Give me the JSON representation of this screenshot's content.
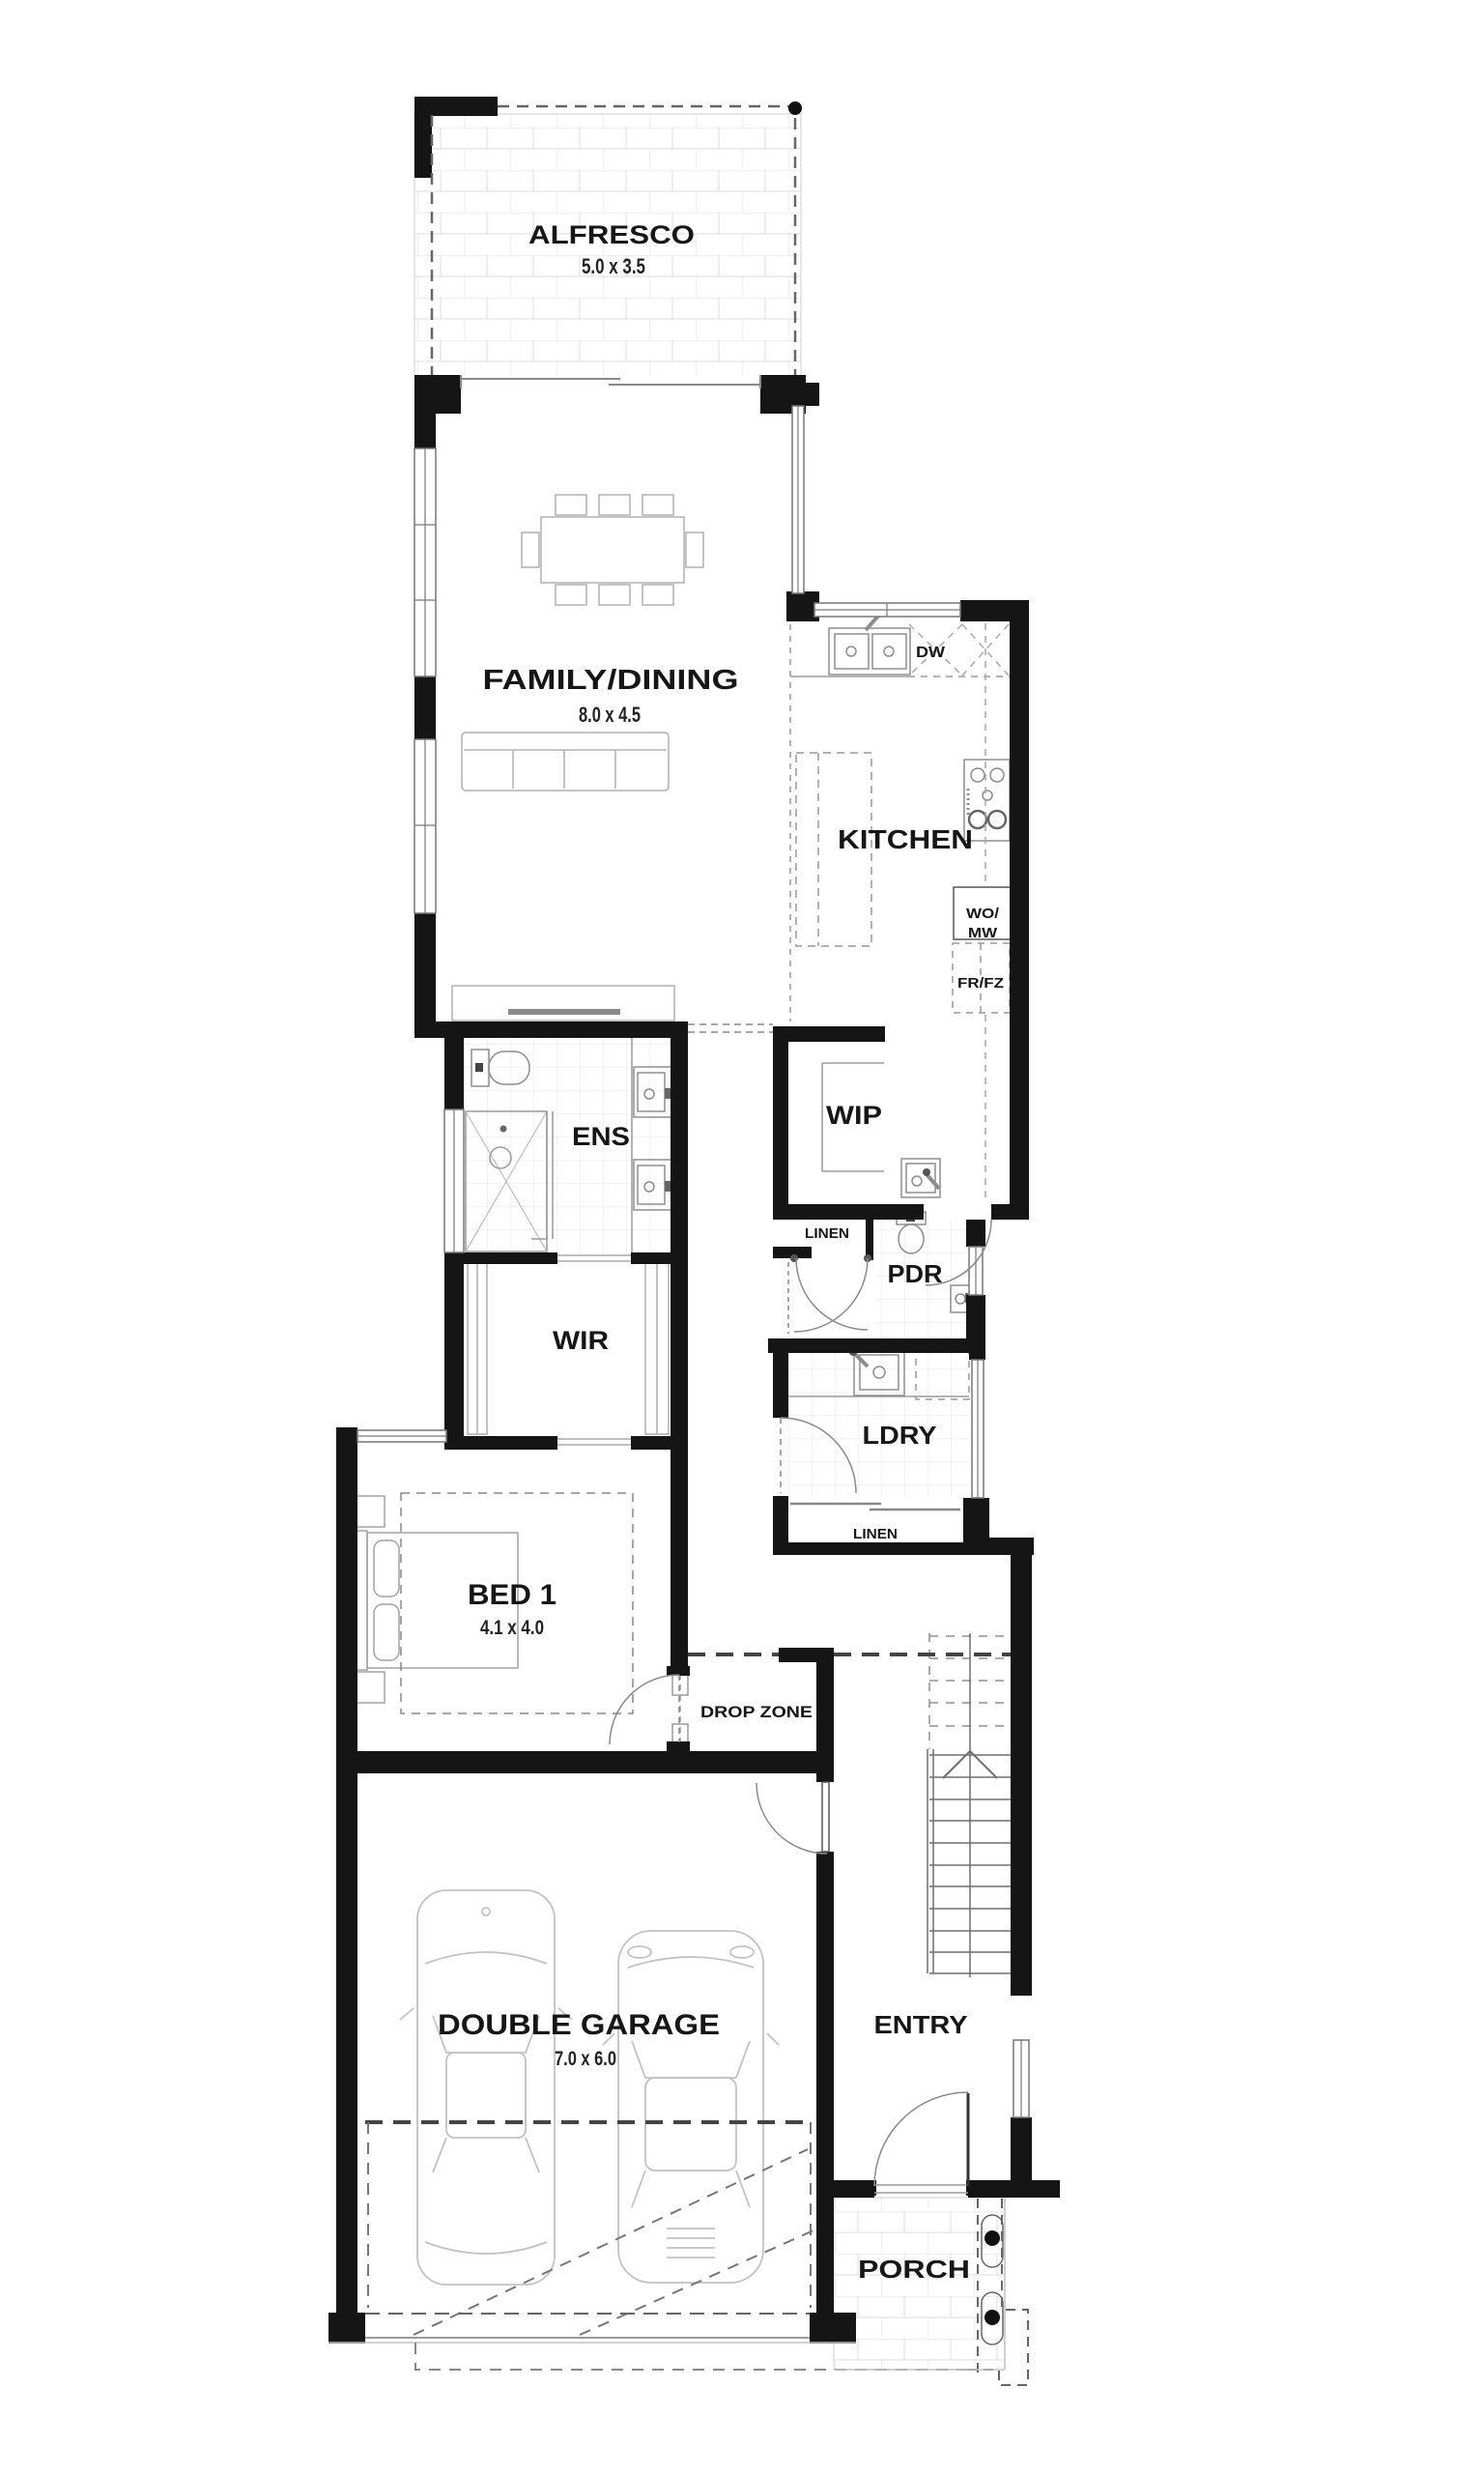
{
  "plan": {
    "rooms": {
      "alfresco": {
        "label": "ALFRESCO",
        "dims": "5.0 x 3.5"
      },
      "family_dining": {
        "label": "FAMILY/DINING",
        "dims": "8.0 x 4.5"
      },
      "kitchen": {
        "label": "KITCHEN"
      },
      "wip": {
        "label": "WIP"
      },
      "ens": {
        "label": "ENS"
      },
      "wir": {
        "label": "WIR"
      },
      "pdr": {
        "label": "PDR"
      },
      "ldry": {
        "label": "LDRY"
      },
      "linen_upper": {
        "label": "LINEN"
      },
      "linen_lower": {
        "label": "LINEN"
      },
      "bed1": {
        "label": "BED 1",
        "dims": "4.1 x 4.0"
      },
      "drop_zone": {
        "label": "DROP ZONE"
      },
      "garage": {
        "label": "DOUBLE GARAGE",
        "dims": "7.0 x 6.0"
      },
      "entry": {
        "label": "ENTRY"
      },
      "porch": {
        "label": "PORCH"
      }
    },
    "appliances": {
      "dw": "DW",
      "wo_mw": [
        "WO/",
        "MW"
      ],
      "fr_fz": "FR/FZ"
    },
    "colors": {
      "wall": "#151515",
      "ink": "#161616",
      "fixture": "#a8a8a8"
    }
  }
}
